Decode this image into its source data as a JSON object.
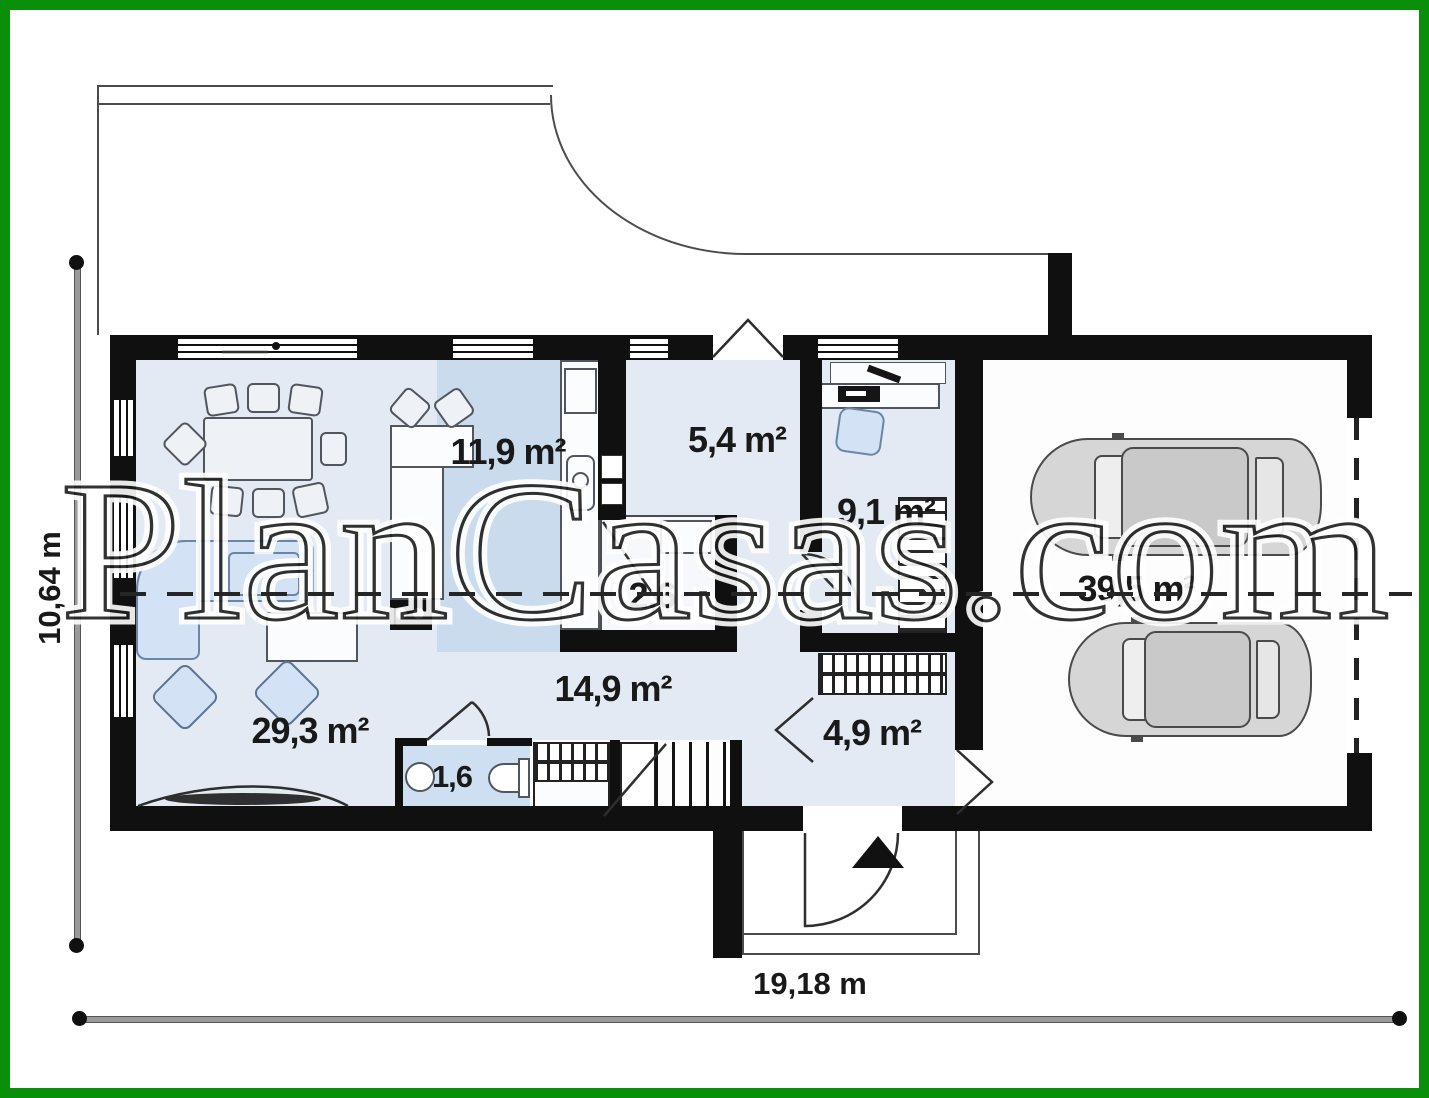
{
  "title": "Single-storey house floor plan",
  "watermark": {
    "text": "PlanCasas.com"
  },
  "frame": {
    "border_color": "#0a8f0a"
  },
  "dimensions": {
    "height_label": "10,64 m",
    "width_label": "19,18 m"
  },
  "rooms": [
    {
      "id": "kitchen",
      "label": "11,9 m²"
    },
    {
      "id": "hall",
      "label": "5,4 m²"
    },
    {
      "id": "office",
      "label": "9,1 m²"
    },
    {
      "id": "closet",
      "label": "2,6"
    },
    {
      "id": "corridor",
      "label": "14,9 m²"
    },
    {
      "id": "living-room",
      "label": "29,3 m²"
    },
    {
      "id": "wc",
      "label": "1,6"
    },
    {
      "id": "vestibule",
      "label": "4,9 m²"
    },
    {
      "id": "garage",
      "label": "39,5 m²"
    }
  ],
  "colors": {
    "frame_green": "#0a8f0a",
    "wall_black": "#101010",
    "room_fill": "#e3eaf4",
    "kitchen_band": "#cadbee",
    "furniture_blue": "#d3e2f4"
  }
}
